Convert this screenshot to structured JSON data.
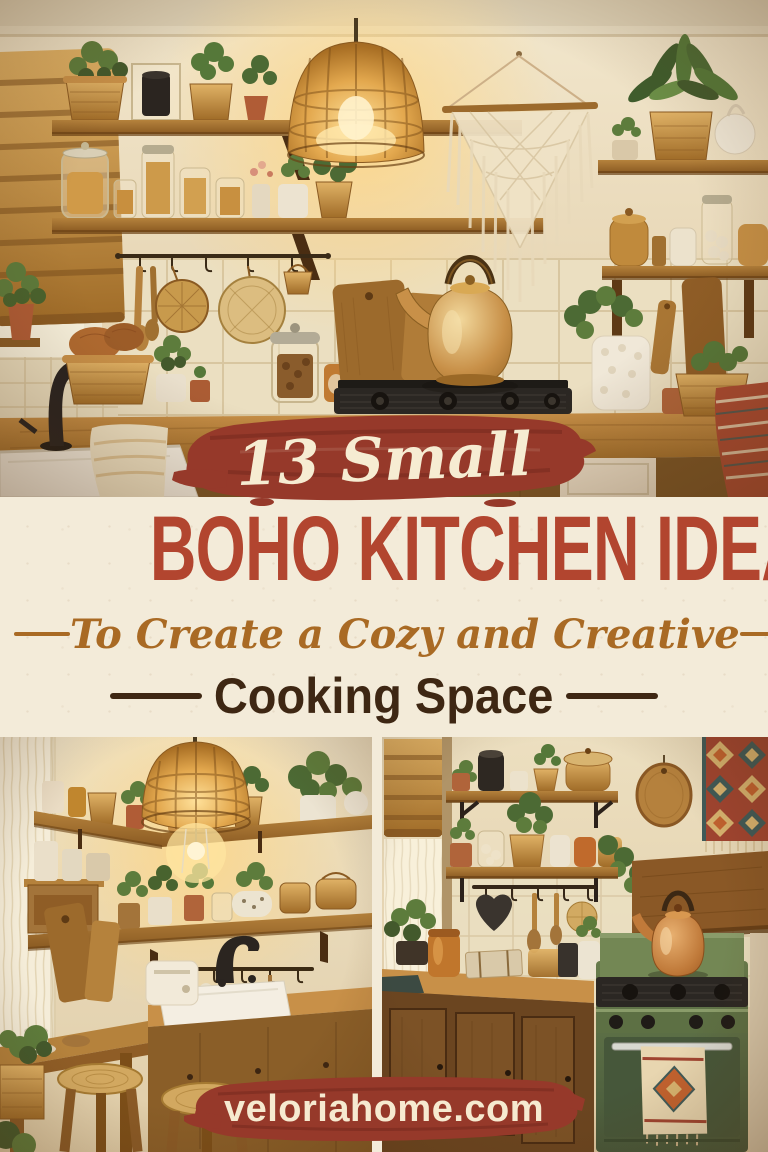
{
  "pin": {
    "eyebrow": "13 Small",
    "title": "BOHO KITCHEN IDEAS",
    "subtitle_script": "To Create a Cozy and Creative",
    "subtitle_bold": "Cooking Space",
    "website": "veloriahome.com",
    "colors": {
      "brush_red": "#96392a",
      "title_red": "#b2452f",
      "panel_cream": "#f3ebd9",
      "cream_text": "#f6ecd2",
      "script_brown": "#a96a24",
      "dark_brown": "#3e2713",
      "banner_cream": "#f6ead0"
    }
  }
}
